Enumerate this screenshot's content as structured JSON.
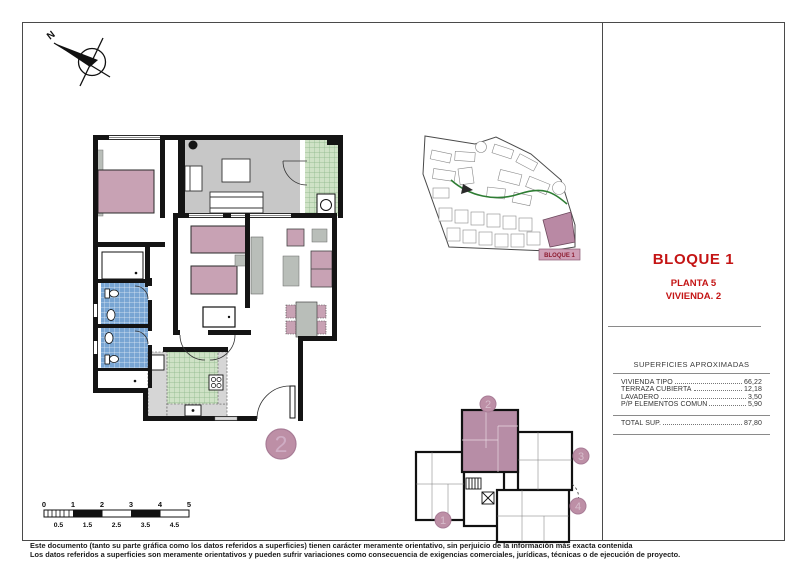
{
  "compass": {
    "north_label": "N"
  },
  "title_block": {
    "bloque": "BLOQUE 1",
    "planta": "PLANTA 5",
    "vivienda": "VIVIENDA. 2"
  },
  "site_plan": {
    "label": "BLOQUE 1"
  },
  "floor_plan": {
    "unit_marker": "2"
  },
  "key_plan": {
    "units": [
      {
        "number": "1",
        "highlighted": false
      },
      {
        "number": "2",
        "highlighted": true
      },
      {
        "number": "3",
        "highlighted": false
      },
      {
        "number": "4",
        "highlighted": false
      }
    ]
  },
  "surfaces": {
    "header": "SUPERFICIES APROXIMADAS",
    "rows": [
      {
        "label": "VIVIENDA TIPO",
        "value": "66,22"
      },
      {
        "label": "TERRAZA CUBIERTA",
        "value": "12,18"
      },
      {
        "label": "LAVADERO",
        "value": "3,50"
      },
      {
        "label": "P/P ELEMENTOS COMUN",
        "value": "5,90"
      }
    ],
    "total": {
      "label": "TOTAL SUP.",
      "value": "87,80"
    }
  },
  "scale_bar": {
    "top_labels": [
      "0",
      "1",
      "2",
      "3",
      "4",
      "5"
    ],
    "bottom_labels": [
      "0.5",
      "1.5",
      "2.5",
      "3.5",
      "4.5"
    ]
  },
  "disclaimer": {
    "line1": "Este documento (tanto su parte gráfica como los datos referidos a superficies) tienen carácter meramente orientativo, sin perjuicio de la información más exacta contenida",
    "line2": "Los datos referidos a superficies son meramente orientativos y pueden sufrir variaciones como consecuencia de exigencias comerciales, jurídicas, técnicas o de ejecución de proyecto."
  },
  "colors": {
    "accent_red": "#c41414",
    "mauve_furniture": "#c8a2b4",
    "mauve_marker": "#bd8fa6",
    "tile_blue": "#78a5d3",
    "tile_green": "#cfe2c6",
    "terrace_gray": "#c7c7c7",
    "site_route_green": "#2e7d33"
  }
}
